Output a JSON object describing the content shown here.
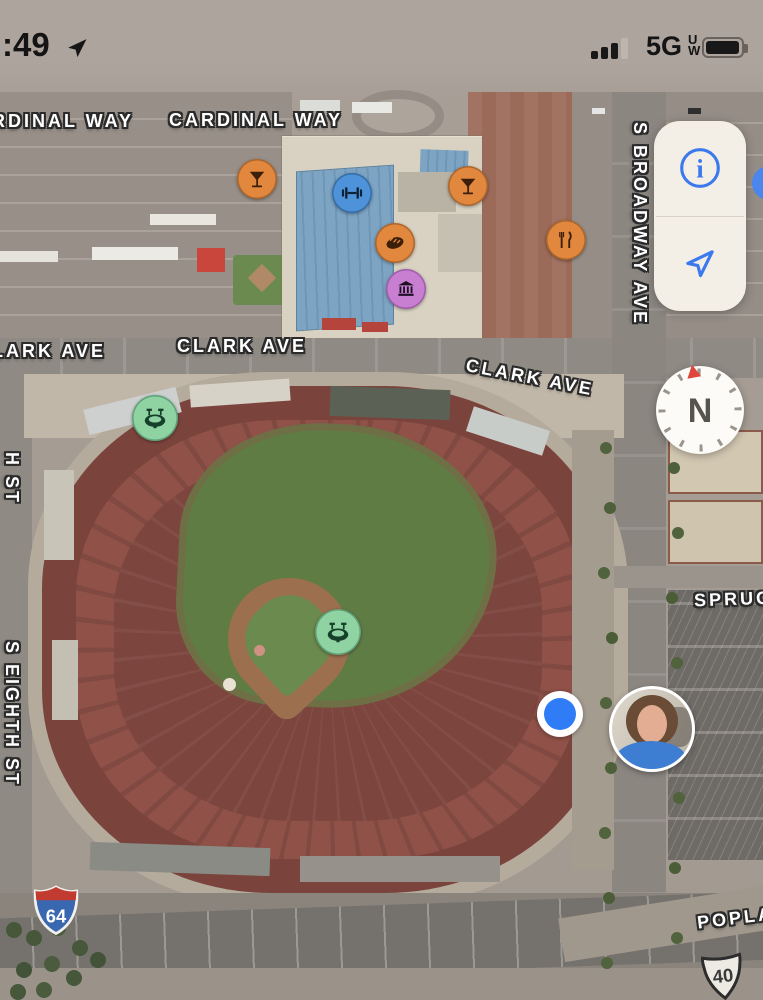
{
  "status_bar": {
    "time": ":49",
    "location_arrow_icon": "location-services-active",
    "signal": {
      "filled_bars": 3,
      "total_bars": 4
    },
    "network": "5G",
    "network_superscript": "U",
    "network_subscript": "W",
    "battery_icon": "battery-high"
  },
  "map_controls": {
    "info_button_glyph": "i",
    "info_button_icon": "info-circle",
    "locate_button_icon": "location-arrow-outline",
    "side_button_color": "#4A86EC",
    "compass": {
      "north_label": "N",
      "needle_color": "#E0473B"
    }
  },
  "street_labels": [
    {
      "text": "RDINAL WAY"
    },
    {
      "text": "CARDINAL WAY"
    },
    {
      "text": "LARK AVE"
    },
    {
      "text": "CLARK AVE"
    },
    {
      "text": "CLARK AVE"
    },
    {
      "text": "S BROADWAY AVE"
    },
    {
      "text": "H ST"
    },
    {
      "text": "S EIGHTH ST"
    },
    {
      "text": "SPRUC"
    },
    {
      "text": "POPLA"
    }
  ],
  "route_shields": [
    {
      "system": "interstate",
      "number": "64",
      "top_color": "#C23B31",
      "body_color": "#3968B1"
    },
    {
      "system": "us-route",
      "number": "40",
      "body_color": "#EDEAE4"
    }
  ],
  "poi_markers": [
    {
      "category": "bar",
      "icon": "cocktail-icon",
      "color": "#E1873E"
    },
    {
      "category": "bar",
      "icon": "cocktail-icon",
      "color": "#E1873E"
    },
    {
      "category": "fitness",
      "icon": "dumbbell-icon",
      "color": "#4E93D9"
    },
    {
      "category": "bakery",
      "icon": "bread-icon",
      "color": "#E1873E"
    },
    {
      "category": "museum",
      "icon": "museum-icon",
      "color": "#C87FD2"
    },
    {
      "category": "restaurant",
      "icon": "fork-knife-icon",
      "color": "#E1873E"
    },
    {
      "category": "stadium",
      "icon": "stadium-icon",
      "color": "#8FD3A3"
    },
    {
      "category": "stadium",
      "icon": "stadium-icon",
      "color": "#8FD3A3"
    }
  ],
  "user": {
    "location_dot_color": "#2F7CF6",
    "avatar": "user-photo-avatar"
  }
}
